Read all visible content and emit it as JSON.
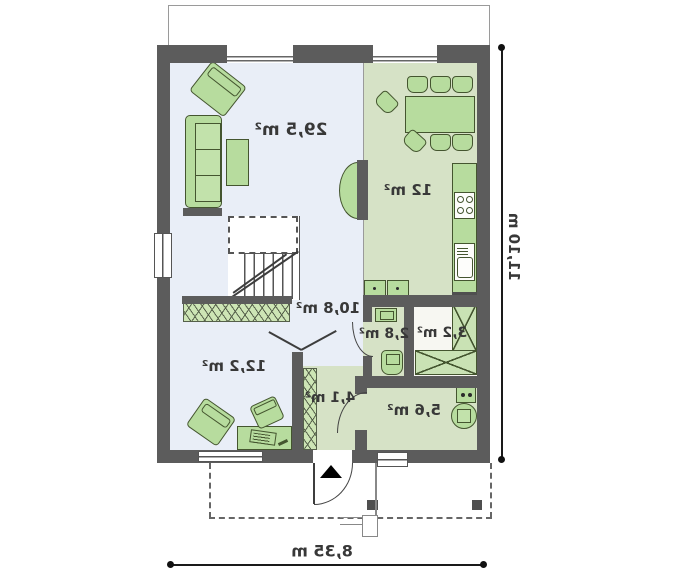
{
  "rooms": [
    {
      "id": "living-room",
      "area": "29,5 m²"
    },
    {
      "id": "kitchen-dining",
      "area": "12 m²"
    },
    {
      "id": "hall",
      "area": "10,8 m²"
    },
    {
      "id": "office",
      "area": "12,2 m²"
    },
    {
      "id": "wc",
      "area": "2,8 m²"
    },
    {
      "id": "pantry",
      "area": "3,2 m²"
    },
    {
      "id": "entry",
      "area": "4,1 m²"
    },
    {
      "id": "utility",
      "area": "5,6 m²"
    }
  ],
  "dimensions": {
    "total_depth": "11,10 m",
    "total_width": "8,35 m"
  },
  "symbols": {
    "entrance_arrow": "triangle-up"
  },
  "colors": {
    "wall": "#5c5c5c",
    "floor_blue": "#e9eef7",
    "floor_green": "#d6e2c6",
    "furniture": "#b7dc9e",
    "furniture_border": "#44552f"
  }
}
